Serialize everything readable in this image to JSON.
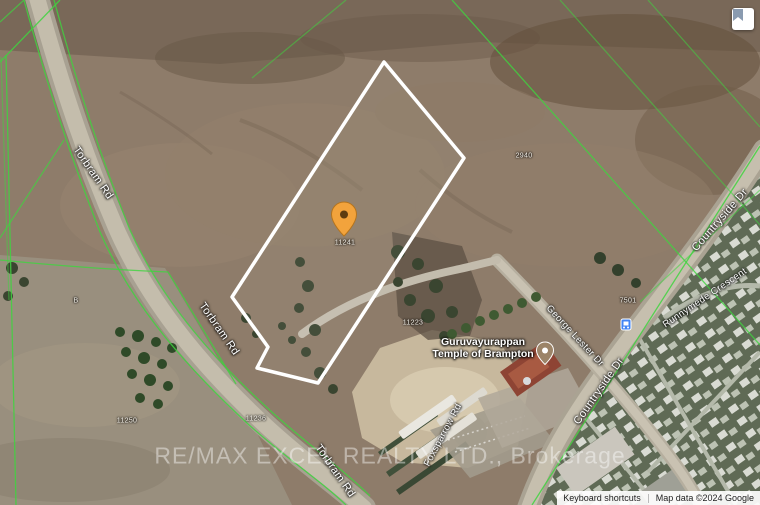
{
  "map": {
    "view": "satellite",
    "watermark": "RE/MAX EXCEL REALTY LTD., Brokerage"
  },
  "roads": {
    "torbram": "Torbram Rd",
    "countryside": "Countryside Dr",
    "george_lester": "George Lester Dr",
    "runnymede": "Runnymede Crescent",
    "foxsparrow": "Foxsparrow Rd"
  },
  "poi": {
    "temple_line1": "Guruvayurappan",
    "temple_line2": "Temple of Brampton"
  },
  "numbers": {
    "subject": "11241",
    "south_neighbor": "11223",
    "north_lot": "2940",
    "east_lot": "7501",
    "bottom_a": "11250",
    "bottom_b": "11236",
    "parcel_letter": "B"
  },
  "attribution": {
    "keyboard_shortcuts": "Keyboard shortcuts",
    "map_data": "Map data ©2024 Google"
  },
  "colors": {
    "cadastral_line": "#3fd43f",
    "parcel_outline": "#ffffff",
    "marker_fill": "#f2a33c",
    "road_label": "#ffffff",
    "transit_blue": "#4285f4"
  }
}
